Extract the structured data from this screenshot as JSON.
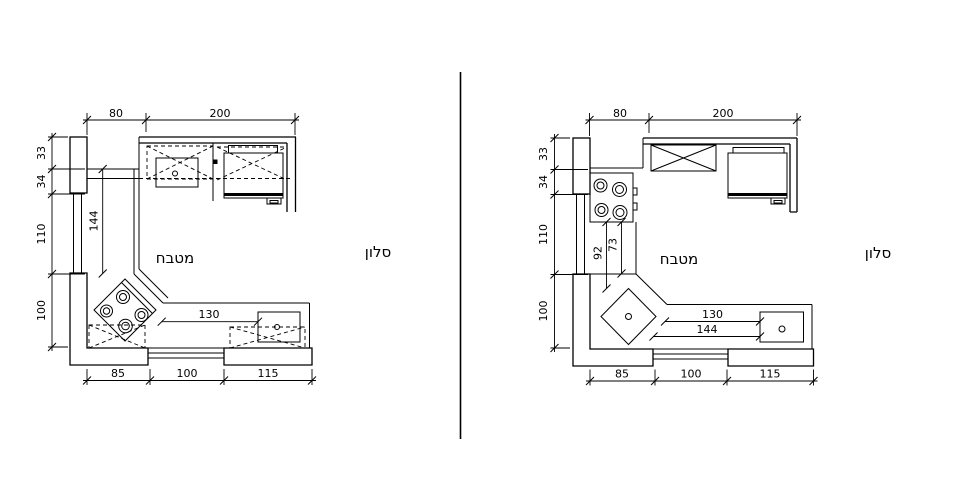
{
  "document": {
    "type": "kitchen-floor-plan-comparison",
    "colors": {
      "line": "#000000",
      "background": "#ffffff"
    }
  },
  "left_plan": {
    "room_label": "מטבח",
    "adjacent_room_label": "סלון",
    "dims": {
      "top": [
        "80",
        "200"
      ],
      "left": [
        "33",
        "34",
        "110",
        "100"
      ],
      "bottom": [
        "85",
        "100",
        "115"
      ],
      "counter_length": "144",
      "counter_run": "130"
    }
  },
  "right_plan": {
    "room_label": "מטבח",
    "adjacent_room_label": "סלון",
    "dims": {
      "top": [
        "80",
        "200"
      ],
      "left": [
        "33",
        "34",
        "110",
        "100"
      ],
      "bottom": [
        "85",
        "100",
        "115"
      ],
      "hob_to_corner": "92",
      "hob_to_counter": "73",
      "counter_run": "130",
      "counter_run_outer": "144"
    }
  }
}
